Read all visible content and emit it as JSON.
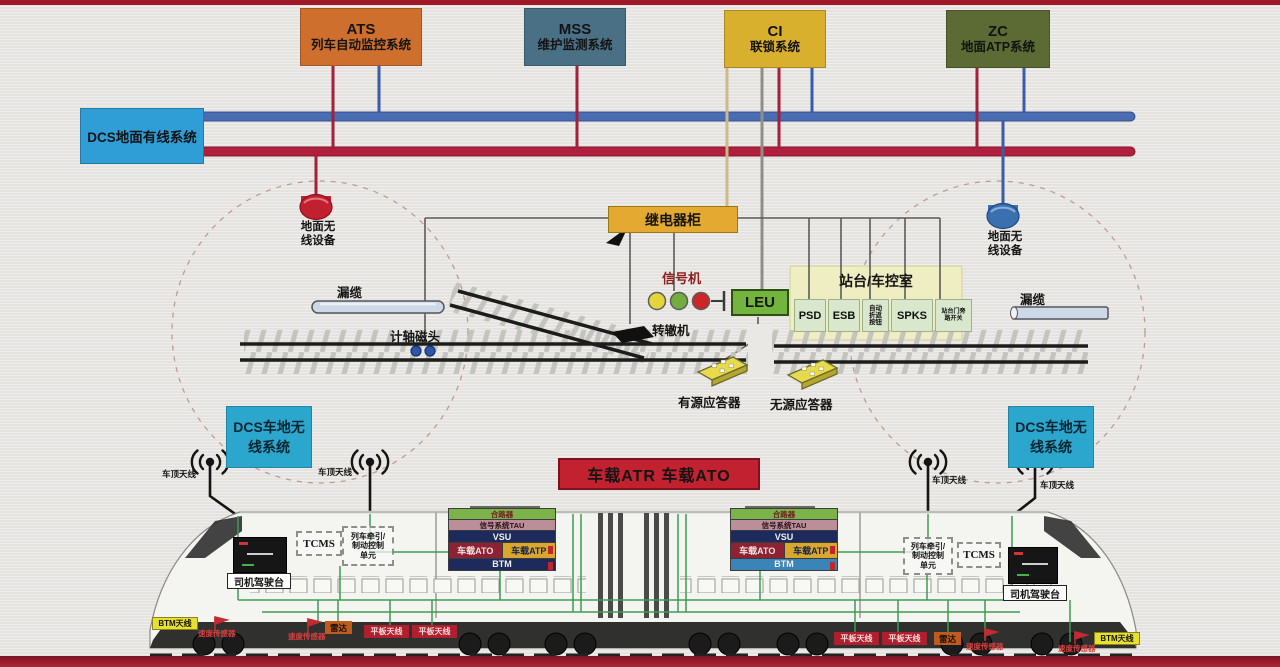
{
  "systems": {
    "ats": {
      "abbr": "ATS",
      "name": "列车自动监控系统"
    },
    "mss": {
      "abbr": "MSS",
      "name": "维护监测系统"
    },
    "ci": {
      "abbr": "CI",
      "name": "联锁系统"
    },
    "zc": {
      "abbr": "ZC",
      "name": "地面ATP系统"
    }
  },
  "dcs": {
    "wired_label": "DCS地面有线系统",
    "wireless_line1": "DCS车地无",
    "wireless_line2": "线系统"
  },
  "wayside": {
    "relay_cabinet": "继电器柜",
    "signal": "信号机",
    "leu": "LEU",
    "point_machine": "转辙机",
    "axle_counter": "计轴磁头",
    "leaky_cable": "漏缆",
    "ground_wireless_line1": "地面无",
    "ground_wireless_line2": "线设备",
    "active_balise": "有源应答器",
    "passive_balise": "无源应答器"
  },
  "station": {
    "title": "站台/车控室",
    "psd": "PSD",
    "esb": "ESB",
    "auto_turnback_l1": "自动",
    "auto_turnback_l2": "折返",
    "auto_turnback_l3": "按钮",
    "spks": "SPKS",
    "door_bypass_l1": "站台门旁",
    "door_bypass_l2": "路开关"
  },
  "onboard": {
    "banner": "车载ATR  车载ATO",
    "roof_antenna": "车顶天线",
    "driver_desk": "司机驾驶台",
    "tcms": "TCMS",
    "traction_l1": "列车牵引/",
    "traction_l2": "制动控制",
    "traction_l3": "单元",
    "rack_combiner": "合路器",
    "rack_tau": "信号系统TAU",
    "rack_vsu": "VSU",
    "rack_ato": "车载ATO",
    "rack_atp": "车载ATP",
    "rack_btm": "BTM",
    "btm_antenna": "BTM天线",
    "speed_sensor": "速度传感器",
    "radar": "雷达",
    "panel_antenna": "平板天线"
  },
  "colors": {
    "ats": "#cf6f2d",
    "mss": "#4a7086",
    "ci": "#d9af2e",
    "zc": "#5c6b33",
    "dcs_wired": "#2f9ed6",
    "dcs_wireless": "#2ba6cc",
    "bus_blue": "#4a6cb3",
    "bus_red": "#b01f3c",
    "relay": "#e3a930",
    "leu": "#72b43e",
    "banner": "#c2212f",
    "station_bg": "#efeec2",
    "station_item": "#d9e8cc"
  }
}
